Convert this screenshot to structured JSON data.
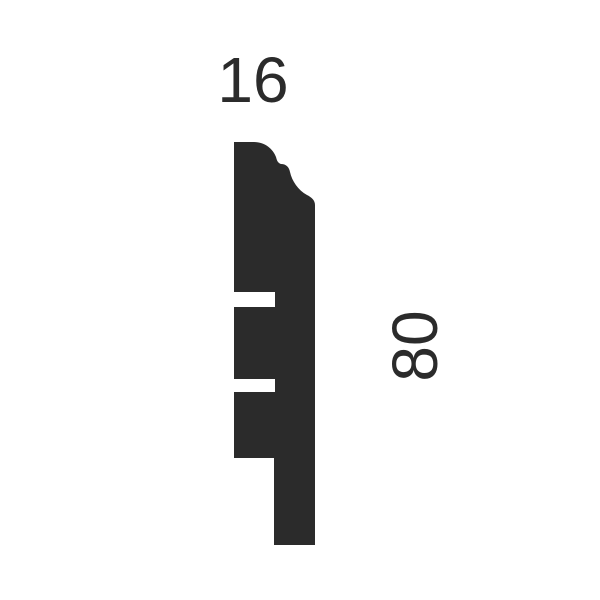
{
  "diagram": {
    "type": "technical-profile-cross-section",
    "subject": "skirting board moulding profile",
    "dimensions": {
      "width_label": "16",
      "height_label": "80"
    },
    "colors": {
      "profile_fill": "#2b2b2b",
      "label_text": "#2b2b2b",
      "background": "#ffffff"
    },
    "profile_path": "M 234 142 L 254 142 C 265 142 273 149 276 157 C 277 161 278 163 281 164 C 286 164 289 167 290 172 C 292 181 298 190 307 195 C 311 197 315 200 315 205 L 315 545 L 274 545 L 274 458 L 234 458 L 234 392 L 275 392 L 275 379 L 234 379 L 234 307 L 275 307 L 275 292 L 234 292 Z",
    "features": {
      "top_edge": "ogee curve",
      "left_notches": 2,
      "bottom": "stepped rebate"
    }
  }
}
